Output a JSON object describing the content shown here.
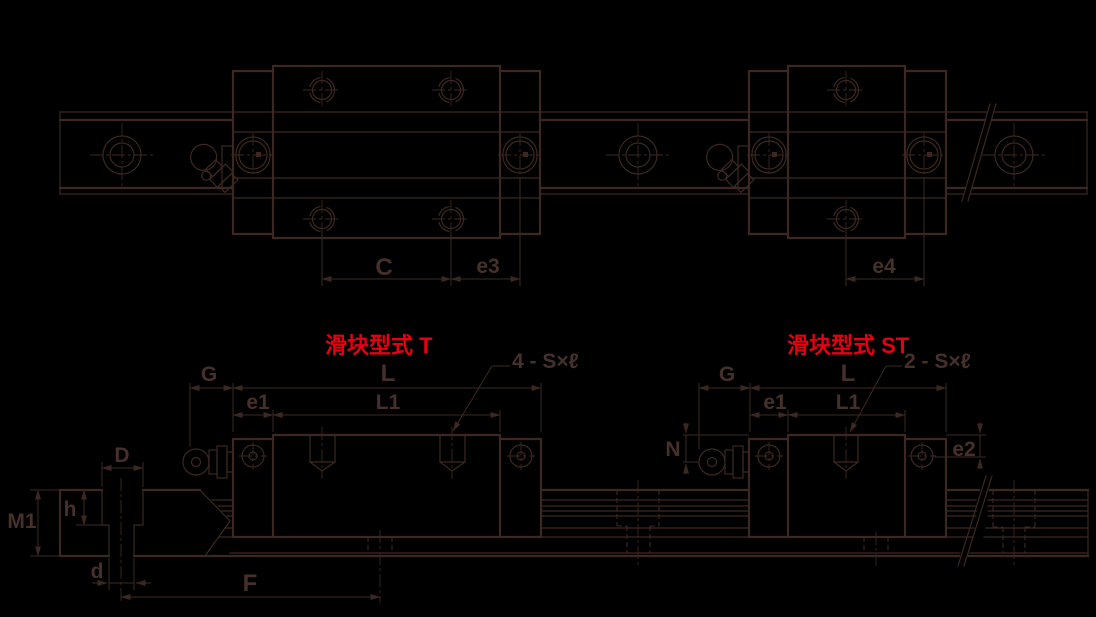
{
  "colors": {
    "background": "#000000",
    "line": "#3c2820",
    "accent_red": "#e60012"
  },
  "titles": {
    "t": "滑块型式 T",
    "st": "滑块型式 ST"
  },
  "top_view": {
    "c": "C",
    "e3": "e3",
    "e4": "e4"
  },
  "side_view": {
    "g": "G",
    "l": "L",
    "l1": "L1",
    "e1": "e1",
    "n": "N",
    "e2": "e2",
    "f": "F",
    "screws_t": "4 - S×ℓ",
    "screws_st": "2 - S×ℓ"
  },
  "rail_section": {
    "d_counterbore": "D",
    "h": "h",
    "m1": "M1",
    "d_bore": "d"
  }
}
